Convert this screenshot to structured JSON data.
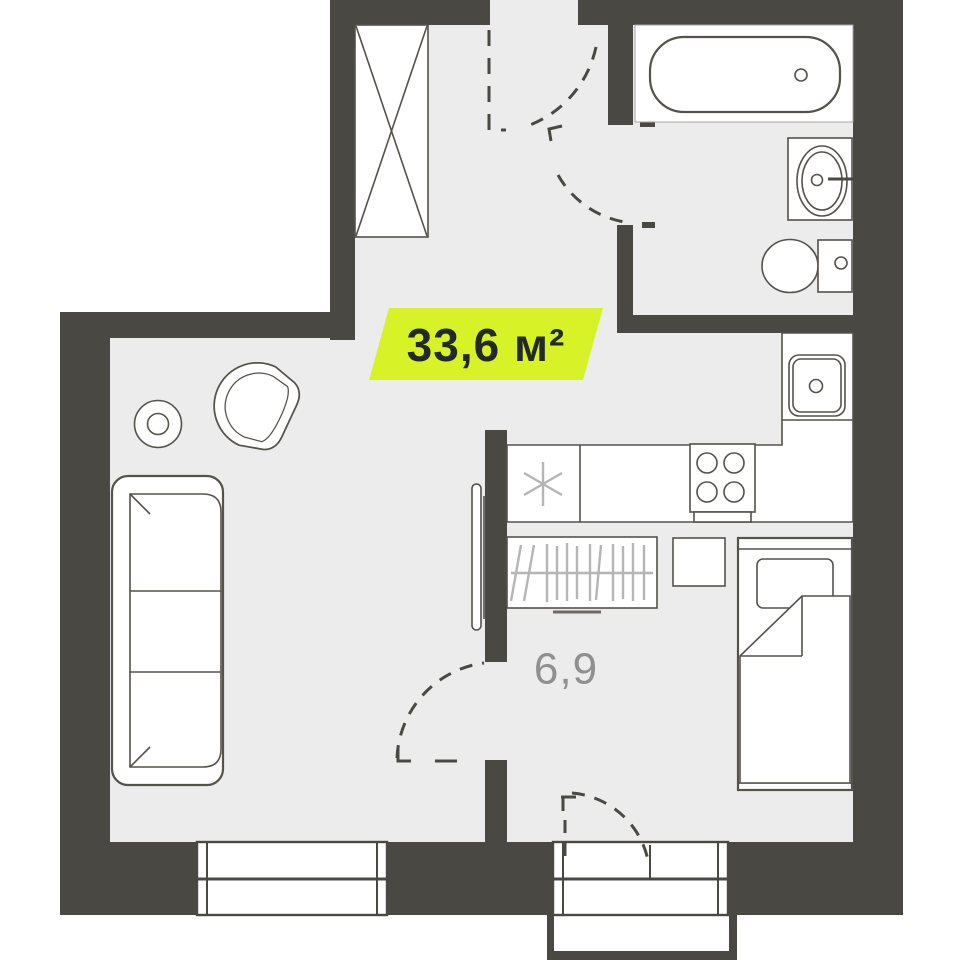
{
  "floorplan": {
    "labels": {
      "area_badge": "33,6 м²",
      "room_area": "6,9"
    },
    "colors": {
      "wall": "#4a4843",
      "floor": "#ececec",
      "stroke": "#55524c",
      "light": "#b5b5b5",
      "badge": "#d7f226",
      "badge_text": "#232a26",
      "room_label": "#8f8f8f"
    },
    "fixtures": [
      "wardrobe-crossed",
      "bathtub",
      "washbasin",
      "toilet",
      "kitchen-sink",
      "stove-burners",
      "refrigerator-asterisk",
      "kitchen-counter",
      "tv-panel",
      "closet-with-hangers",
      "sofa",
      "armchair",
      "side-table",
      "bed",
      "nightstand",
      "window",
      "balcony-door-window",
      "balcony",
      "entry-door-swing",
      "bathroom-door-swing",
      "room-door-swing",
      "balcony-door-swing"
    ]
  }
}
